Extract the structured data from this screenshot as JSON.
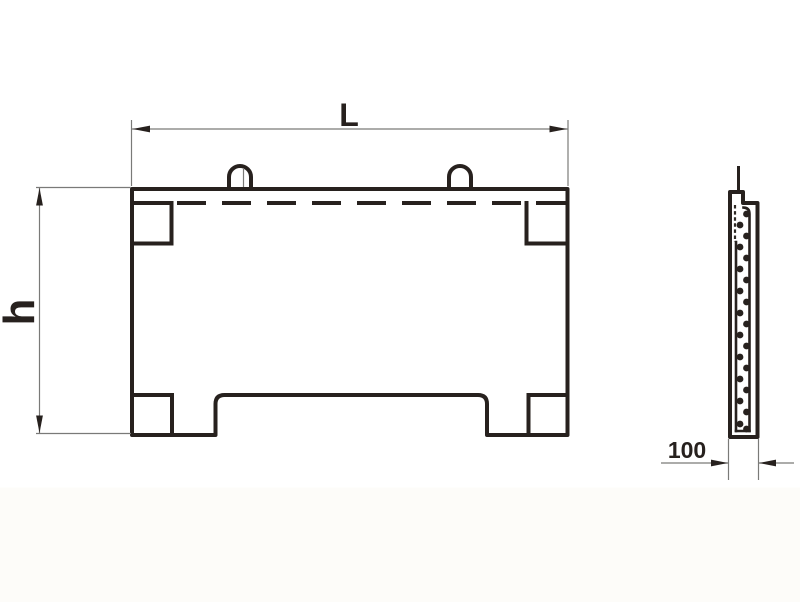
{
  "drawing": {
    "labels": {
      "length": "L",
      "height": "h",
      "thickness": "100"
    },
    "colors": {
      "ink": "#27211e",
      "thin_line": "#7a7a78",
      "background": "#ffffff"
    }
  }
}
